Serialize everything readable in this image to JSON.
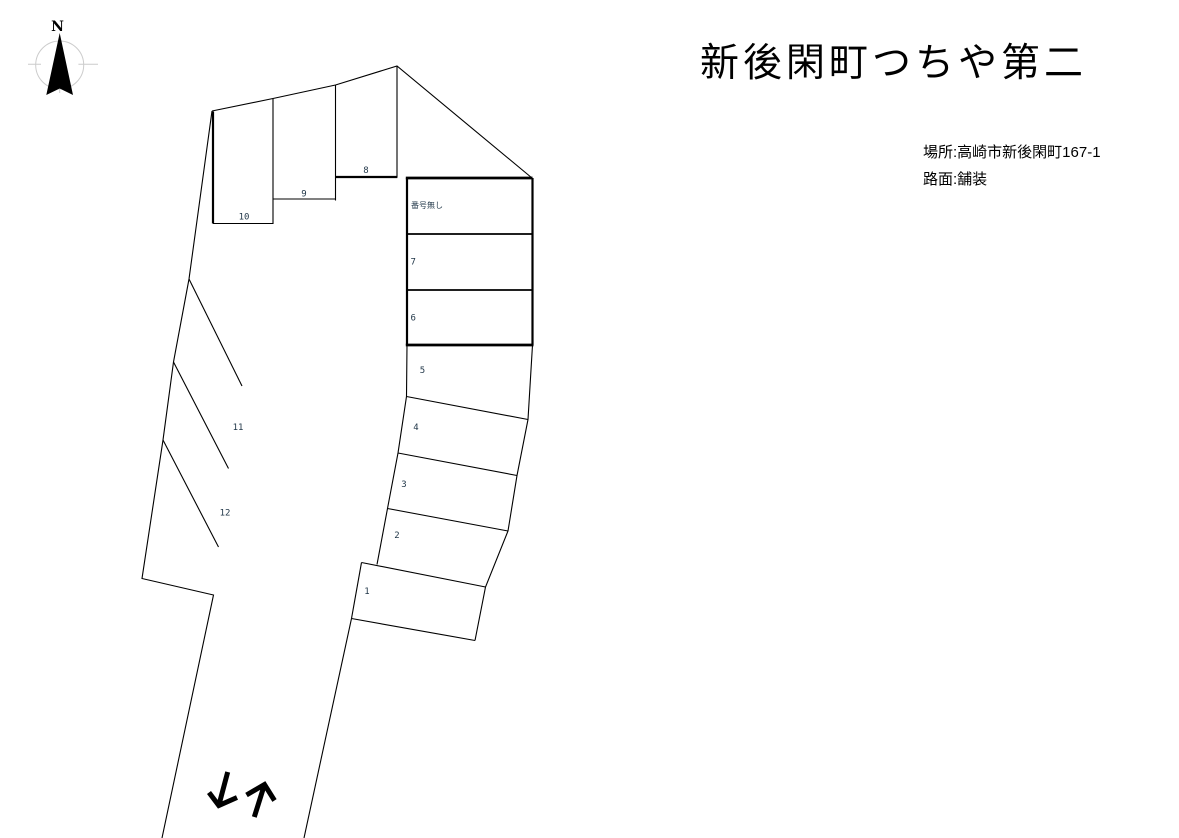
{
  "header": {
    "title": "新後閑町つちや第二"
  },
  "info": {
    "location": "場所:高崎市新後閑町167-1",
    "surface": "路面:舗装"
  },
  "compass": {
    "north_label": "N"
  },
  "lot": {
    "unnumbered_label": "番号無し",
    "spaces": [
      {
        "label": "1"
      },
      {
        "label": "2"
      },
      {
        "label": "3"
      },
      {
        "label": "4"
      },
      {
        "label": "5"
      },
      {
        "label": "6"
      },
      {
        "label": "7"
      },
      {
        "label": "8"
      },
      {
        "label": "9"
      },
      {
        "label": "10"
      },
      {
        "label": "11"
      },
      {
        "label": "12"
      }
    ]
  },
  "icons": {
    "down_arrow": "↓",
    "up_arrow": "↑",
    "compass": "north-arrow"
  },
  "colors": {
    "line": "#000000",
    "compass_ring": "#cccccc",
    "label_text": "#1f3547",
    "background": "#ffffff"
  }
}
